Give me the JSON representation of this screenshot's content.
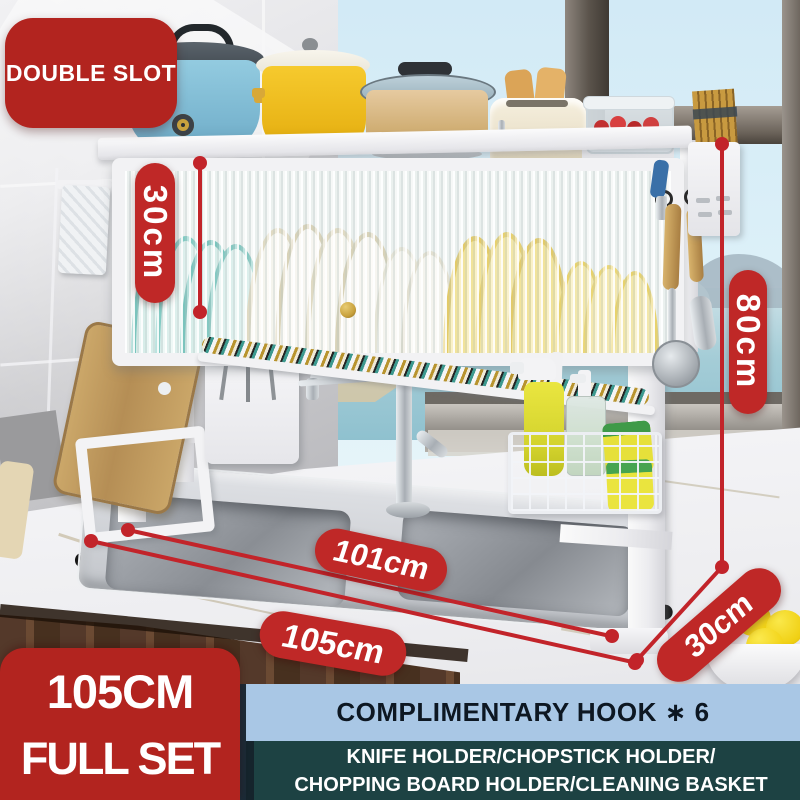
{
  "badges": {
    "double_slot": "DOUBLE SLOT",
    "cabinet_height": "30cm",
    "total_height": "80cm",
    "sink_inner_width": "101cm",
    "rack_width": "105cm",
    "rack_depth": "30cm"
  },
  "set_box": {
    "line1": "105CM",
    "line2": "FULL SET"
  },
  "banners": {
    "complimentary": "COMPLIMENTARY HOOK ∗ 6",
    "includes_line1": "KNIFE HOLDER/CHOPSTICK HOLDER/",
    "includes_line2": "CHOPPING BOARD HOLDER/CLEANING BASKET"
  },
  "colors": {
    "badge_red": "#b2241f",
    "accent_red": "#bf2827",
    "line_red": "#c2242a",
    "banner_blue": "#a9c7e5",
    "banner_teal": "#1d4243",
    "banner_text": "#0d1722",
    "text_white": "#ffffff"
  }
}
